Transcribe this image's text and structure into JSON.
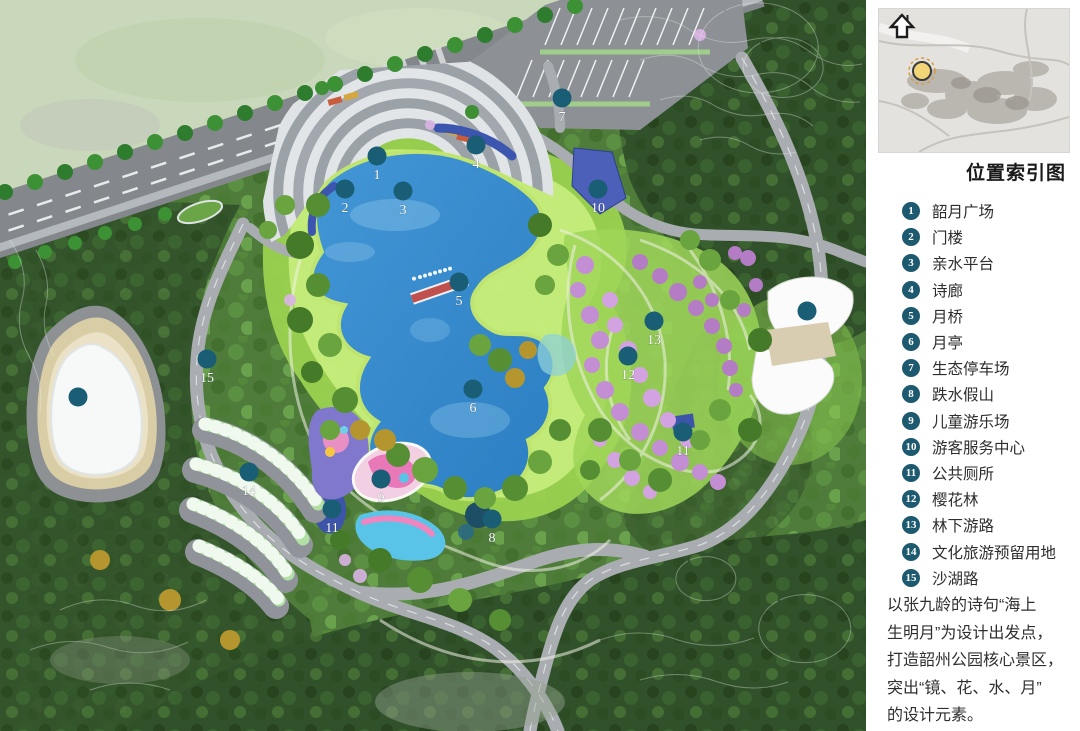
{
  "panel": {
    "north_label": "N",
    "title": "位置索引图",
    "legend": [
      {
        "num": "1",
        "label": "韶月广场"
      },
      {
        "num": "2",
        "label": "门楼"
      },
      {
        "num": "3",
        "label": "亲水平台"
      },
      {
        "num": "4",
        "label": "诗廊"
      },
      {
        "num": "5",
        "label": "月桥"
      },
      {
        "num": "6",
        "label": "月亭"
      },
      {
        "num": "7",
        "label": "生态停车场"
      },
      {
        "num": "8",
        "label": "跌水假山"
      },
      {
        "num": "9",
        "label": "儿童游乐场"
      },
      {
        "num": "10",
        "label": "游客服务中心"
      },
      {
        "num": "11",
        "label": "公共厕所"
      },
      {
        "num": "12",
        "label": "樱花林"
      },
      {
        "num": "13",
        "label": "林下游路"
      },
      {
        "num": "14",
        "label": "文化旅游预留用地"
      },
      {
        "num": "15",
        "label": "沙湖路"
      }
    ],
    "description_lines": [
      "以张九龄的诗句“海上",
      "生明月”为设计出发点，",
      "打造韶州公园核心景区，",
      "突出“镜、花、水、月”",
      "的设计元素。"
    ],
    "colors": {
      "badge": "#1d5a70",
      "site_dot": "#f2d577"
    }
  },
  "map": {
    "colors": {
      "marker": "#1a5e76",
      "lake": "#2e82c6",
      "bridge": "#c0504d"
    },
    "markers": [
      {
        "num": "1",
        "x": 377,
        "y": 156
      },
      {
        "num": "2",
        "x": 345,
        "y": 189
      },
      {
        "num": "3",
        "x": 403,
        "y": 191
      },
      {
        "num": "4",
        "x": 476,
        "y": 145
      },
      {
        "num": "5",
        "x": 459,
        "y": 282
      },
      {
        "num": "6",
        "x": 473,
        "y": 389
      },
      {
        "num": "7",
        "x": 562,
        "y": 98
      },
      {
        "num": "8",
        "x": 492,
        "y": 519
      },
      {
        "num": "9",
        "x": 381,
        "y": 479
      },
      {
        "num": "10",
        "x": 598,
        "y": 189
      },
      {
        "num": "11",
        "x": 332,
        "y": 509
      },
      {
        "num": "11",
        "x": 683,
        "y": 432
      },
      {
        "num": "12",
        "x": 628,
        "y": 356
      },
      {
        "num": "13",
        "x": 654,
        "y": 321
      },
      {
        "num": "14",
        "x": 249,
        "y": 472
      },
      {
        "num": "15",
        "x": 207,
        "y": 359
      },
      {
        "num": "",
        "x": 78,
        "y": 397
      },
      {
        "num": "",
        "x": 807,
        "y": 311
      }
    ]
  }
}
